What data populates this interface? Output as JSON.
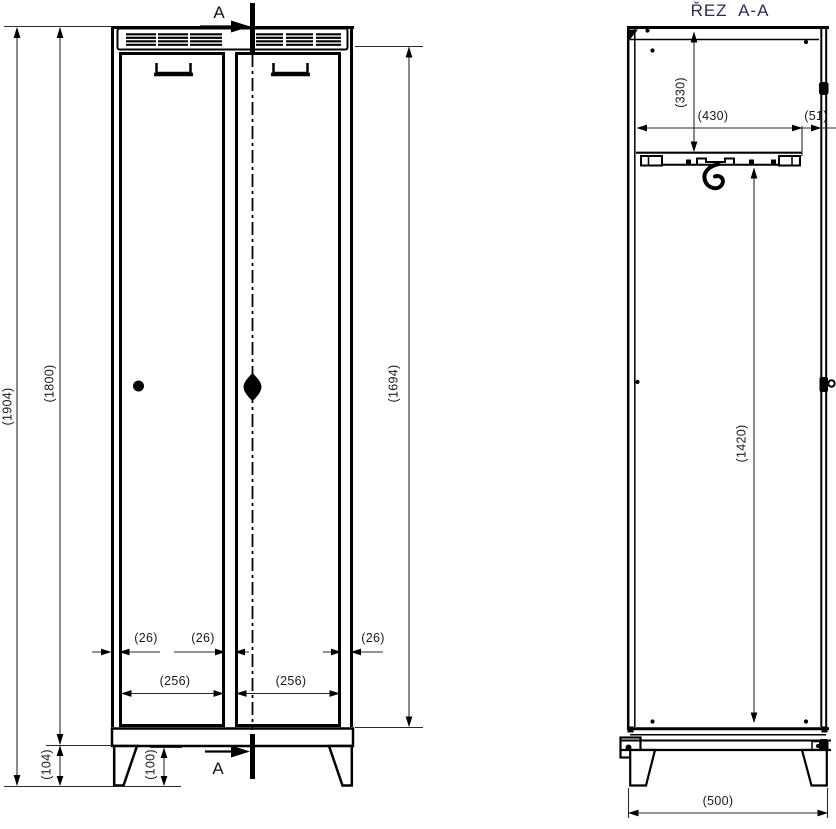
{
  "front_view": {
    "section_label": "A",
    "dims": {
      "total_height": "(1904)",
      "body_height": "(1800)",
      "door_height": "(1694)",
      "plinth_height": "(104)",
      "foot_height": "(100)",
      "gap_left": "(26)",
      "gap_center": "(26)",
      "gap_right": "(26)",
      "door_width_left": "(256)",
      "door_width_right": "(256)"
    }
  },
  "section_view": {
    "title": "ŘEZ  A-A",
    "dims": {
      "top_shelf_depth": "(330)",
      "shelf_width": "(430)",
      "front_gap": "(51)",
      "hanging_height": "(1420)",
      "overall_depth": "(500)"
    }
  },
  "colors": {
    "line_color": "#000000",
    "title_color": "#2b2b55",
    "dim_text_color": "#1a1a1a"
  }
}
